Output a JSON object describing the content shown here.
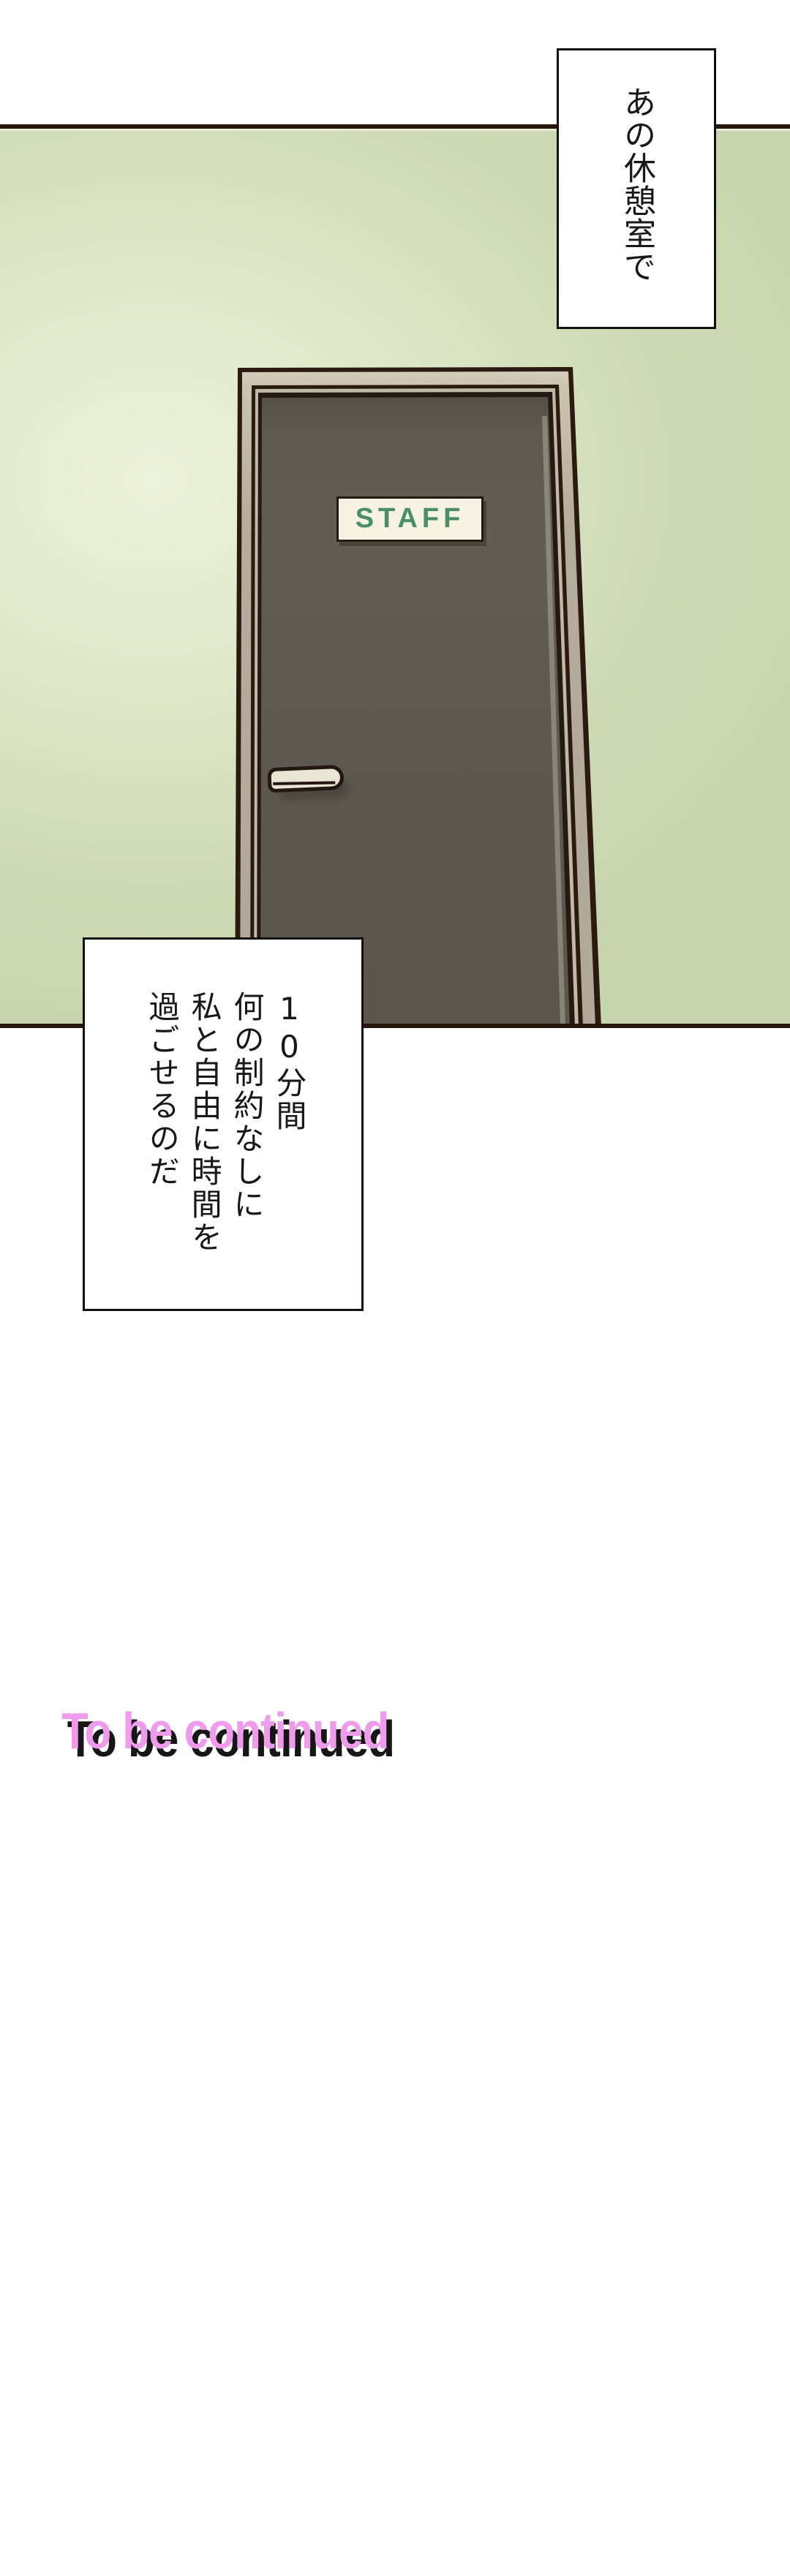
{
  "comic": {
    "bubbles": {
      "top": {
        "text": "あの休憩室で"
      },
      "bottom": {
        "text": "10分間\n何の制約なしに\n私と自由に時間を\n過ごせるのだ"
      }
    },
    "door": {
      "sign_label": "STAFF",
      "sign_text_color": "#4a8f63",
      "sign_bg_color": "#f7f2e3",
      "frame_color": "#b6ac9c",
      "face_color": "#5d5950",
      "outline_color": "#2b1a10",
      "handle_color": "#e9e4d4"
    },
    "wall": {
      "base_color": "#cfdbb6",
      "glow_color": "#edf2da",
      "panel_border_color": "#27140b"
    },
    "footer": {
      "to_be_continued": "To be continued",
      "text_color": "#ee9bec",
      "shadow_color": "#161616"
    }
  }
}
